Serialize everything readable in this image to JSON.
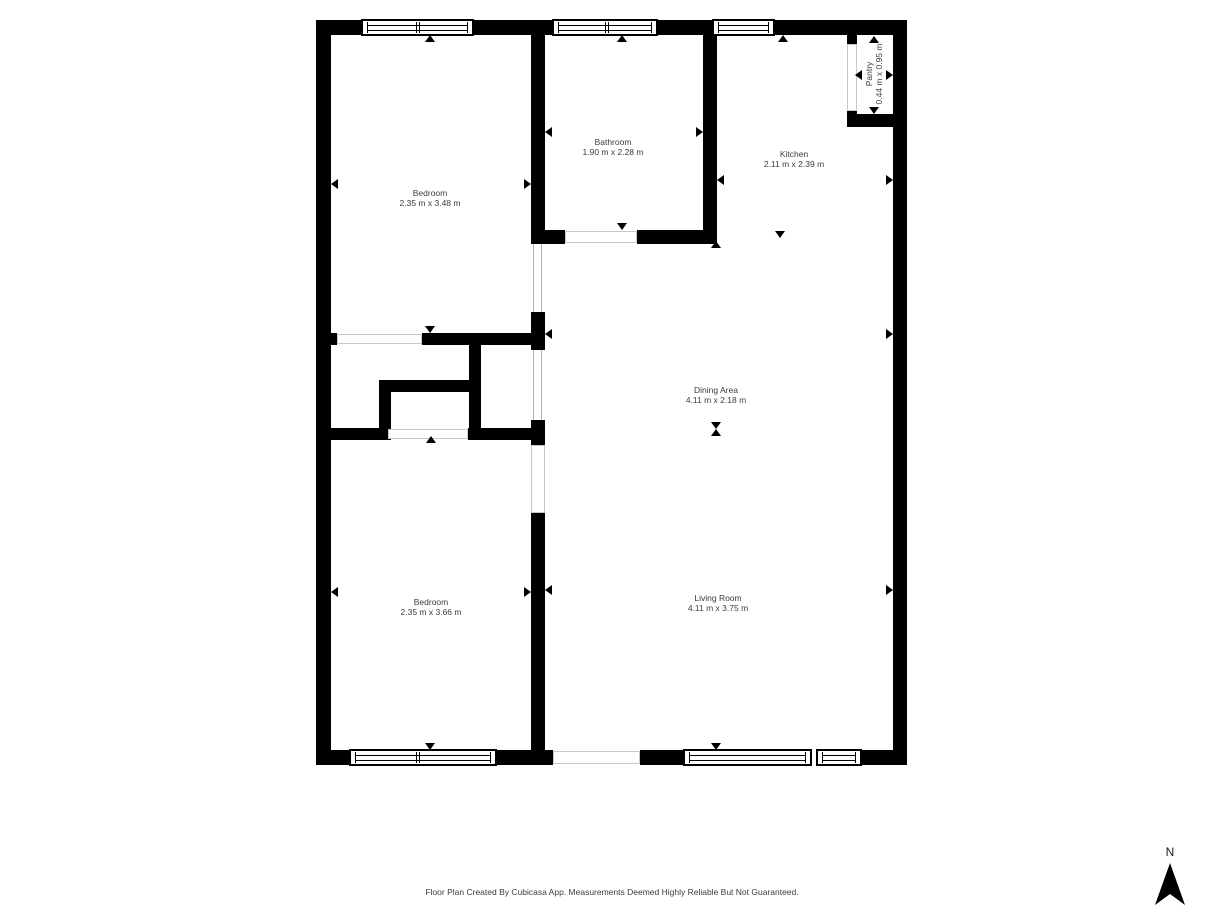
{
  "footer": {
    "text": "Floor Plan Created By Cubicasa App. Measurements Deemed Highly Reliable But Not Guaranteed."
  },
  "compass": {
    "label": "N"
  },
  "colors": {
    "wall": "#000000",
    "text": "#3c3c3c",
    "open_boundary": "#b3b3b3",
    "background": "#ffffff"
  },
  "rooms": [
    {
      "name": "Bedroom",
      "dimensions": "2.35 m x 3.48 m",
      "label_x": 430,
      "label_y": 198,
      "rotated": false
    },
    {
      "name": "Bathroom",
      "dimensions": "1.90 m x 2.28 m",
      "label_x": 613,
      "label_y": 147,
      "rotated": false
    },
    {
      "name": "Kitchen",
      "dimensions": "2.11 m x 2.39 m",
      "label_x": 794,
      "label_y": 159,
      "rotated": false
    },
    {
      "name": "Pantry",
      "dimensions": "0.44 m x 0.95 m",
      "label_x": 874,
      "label_y": 74,
      "rotated": true
    },
    {
      "name": "Dining Area",
      "dimensions": "4.11 m x 2.18 m",
      "label_x": 716,
      "label_y": 395,
      "rotated": false
    },
    {
      "name": "Bedroom",
      "dimensions": "2.35 m x 3.66 m",
      "label_x": 431,
      "label_y": 607,
      "rotated": false
    },
    {
      "name": "Living Room",
      "dimensions": "4.11 m x 3.75 m",
      "label_x": 718,
      "label_y": 603,
      "rotated": false
    }
  ],
  "geometry": {
    "walls": [
      [
        316,
        20,
        45,
        15
      ],
      [
        474,
        20,
        78,
        15
      ],
      [
        658,
        20,
        54,
        15
      ],
      [
        775,
        20,
        132,
        15
      ],
      [
        316,
        20,
        15,
        745
      ],
      [
        893,
        20,
        14,
        745
      ],
      [
        316,
        750,
        33,
        15
      ],
      [
        497,
        750,
        56,
        15
      ],
      [
        640,
        750,
        43,
        15
      ],
      [
        862,
        750,
        45,
        15
      ],
      [
        531,
        35,
        14,
        209
      ],
      [
        703,
        35,
        14,
        209
      ],
      [
        531,
        230,
        34,
        14
      ],
      [
        637,
        230,
        80,
        14
      ],
      [
        422,
        333,
        123,
        12
      ],
      [
        331,
        333,
        6,
        12
      ],
      [
        379,
        380,
        102,
        12
      ],
      [
        379,
        380,
        12,
        60
      ],
      [
        469,
        345,
        12,
        95
      ],
      [
        316,
        428,
        72,
        12
      ],
      [
        468,
        428,
        77,
        12
      ],
      [
        531,
        312,
        14,
        38
      ],
      [
        531,
        420,
        14,
        25
      ],
      [
        531,
        513,
        14,
        252
      ],
      [
        847,
        21,
        10,
        23
      ],
      [
        847,
        111,
        10,
        16
      ],
      [
        847,
        114,
        60,
        13
      ]
    ],
    "windows": [
      {
        "x": 361,
        "y": 19,
        "w": 113,
        "h": 17,
        "dividers": [
          54
        ]
      },
      {
        "x": 552,
        "y": 19,
        "w": 106,
        "h": 17,
        "dividers": [
          52
        ]
      },
      {
        "x": 712,
        "y": 19,
        "w": 63,
        "h": 17,
        "dividers": []
      },
      {
        "x": 349,
        "y": 749,
        "w": 148,
        "h": 17,
        "dividers": [
          66
        ]
      },
      {
        "x": 683,
        "y": 749,
        "w": 129,
        "h": 17,
        "dividers": []
      },
      {
        "x": 816,
        "y": 749,
        "w": 46,
        "h": 17,
        "dividers": []
      }
    ],
    "openings": [
      {
        "x": 337,
        "y": 334,
        "w": 85,
        "h": 10
      },
      {
        "x": 388,
        "y": 429,
        "w": 80,
        "h": 10
      },
      {
        "x": 565,
        "y": 231,
        "w": 72,
        "h": 12
      },
      {
        "x": 553,
        "y": 751,
        "w": 87,
        "h": 13
      },
      {
        "x": 531,
        "y": 445,
        "w": 14,
        "h": 68
      },
      {
        "x": 847,
        "y": 44,
        "w": 10,
        "h": 67
      }
    ],
    "open_boundaries": [
      {
        "x": 533,
        "y": 244,
        "w": 9,
        "h": 68
      },
      {
        "x": 533,
        "y": 350,
        "w": 9,
        "h": 70
      }
    ],
    "markers": [
      {
        "x": 430,
        "y": 35,
        "dir": "up"
      },
      {
        "x": 430,
        "y": 333,
        "dir": "down"
      },
      {
        "x": 331,
        "y": 184,
        "dir": "left"
      },
      {
        "x": 531,
        "y": 184,
        "dir": "right"
      },
      {
        "x": 622,
        "y": 35,
        "dir": "up"
      },
      {
        "x": 622,
        "y": 230,
        "dir": "down"
      },
      {
        "x": 545,
        "y": 132,
        "dir": "left"
      },
      {
        "x": 703,
        "y": 132,
        "dir": "right"
      },
      {
        "x": 783,
        "y": 35,
        "dir": "up"
      },
      {
        "x": 780,
        "y": 238,
        "dir": "down"
      },
      {
        "x": 717,
        "y": 180,
        "dir": "left"
      },
      {
        "x": 893,
        "y": 180,
        "dir": "right"
      },
      {
        "x": 874,
        "y": 36,
        "dir": "up"
      },
      {
        "x": 874,
        "y": 114,
        "dir": "down"
      },
      {
        "x": 855,
        "y": 75,
        "dir": "left"
      },
      {
        "x": 893,
        "y": 75,
        "dir": "right"
      },
      {
        "x": 716,
        "y": 241,
        "dir": "up"
      },
      {
        "x": 716,
        "y": 429,
        "dir": "down"
      },
      {
        "x": 545,
        "y": 334,
        "dir": "left"
      },
      {
        "x": 893,
        "y": 334,
        "dir": "right"
      },
      {
        "x": 716,
        "y": 429,
        "dir": "up"
      },
      {
        "x": 716,
        "y": 750,
        "dir": "down"
      },
      {
        "x": 545,
        "y": 590,
        "dir": "left"
      },
      {
        "x": 893,
        "y": 590,
        "dir": "right"
      },
      {
        "x": 431,
        "y": 436,
        "dir": "up"
      },
      {
        "x": 430,
        "y": 750,
        "dir": "down"
      },
      {
        "x": 331,
        "y": 592,
        "dir": "left"
      },
      {
        "x": 531,
        "y": 592,
        "dir": "right"
      }
    ]
  }
}
